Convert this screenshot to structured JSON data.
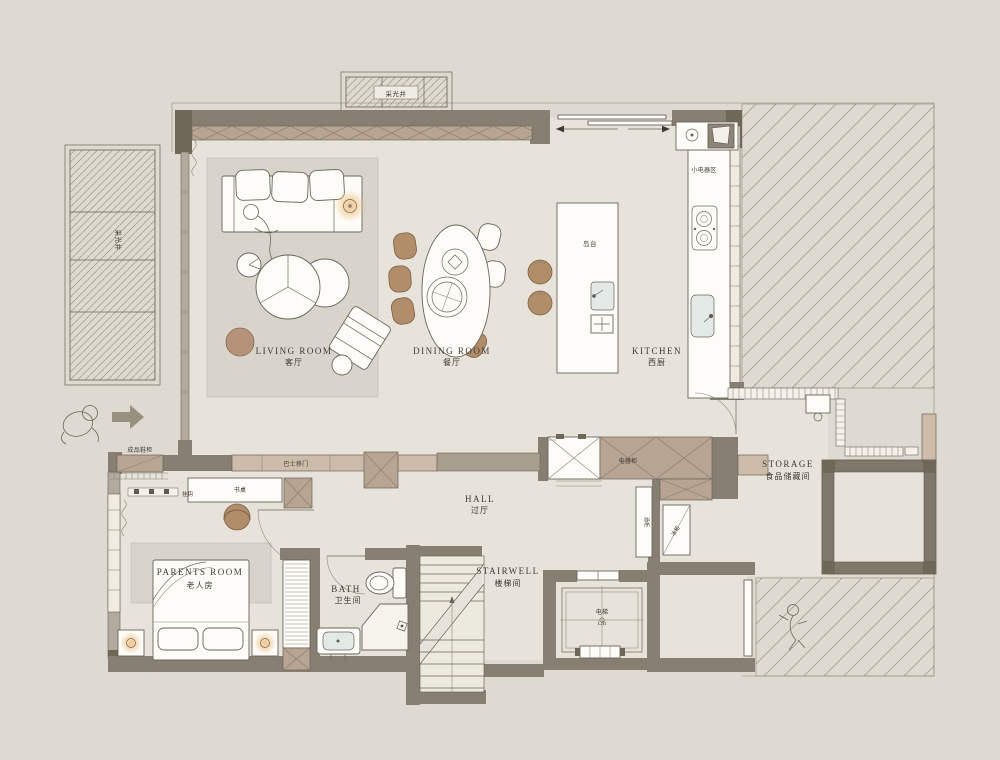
{
  "palette": {
    "canvas": "#dedad1",
    "floor": "#e7e3da",
    "wall": "#867f72",
    "cabinet_tan": "#b7a492",
    "wood_brown": "#b18d69",
    "rug_gray": "#d8d4cc",
    "hatch_line": "#a59c8d",
    "lamp_glow": "#f0c387",
    "ink": "#3f3a31"
  },
  "labels": {
    "lightwell": "采光井",
    "living_en": "LIVING ROOM",
    "living_zh": "客厅",
    "dining_en": "DINING ROOM",
    "dining_zh": "餐厅",
    "kitchen_en": "KITCHEN",
    "kitchen_zh": "西厨",
    "hall_en": "HALL",
    "hall_zh": "过厅",
    "parents_en": "PARENTS ROOM",
    "parents_zh": "老人房",
    "bath_en": "BATH",
    "bath_zh": "卫生间",
    "stairwell_en": "STAIRWELL",
    "stairwell_zh": "楼梯间",
    "storage_en": "STORAGE",
    "storage_zh": "食品储藏间",
    "elevator_zh": "电梯",
    "elevator_en": "Lift",
    "island": "岛台",
    "small_appliance_area": "小电器区",
    "appliance_cabinet": "电器柜",
    "freezer": "冰柜",
    "tall_cabinet": "酒柜",
    "shoe_cabinet": "成品鞋柜",
    "sliding_door": "巴士移门",
    "desk": "书桌",
    "hooks": "挂钩"
  }
}
